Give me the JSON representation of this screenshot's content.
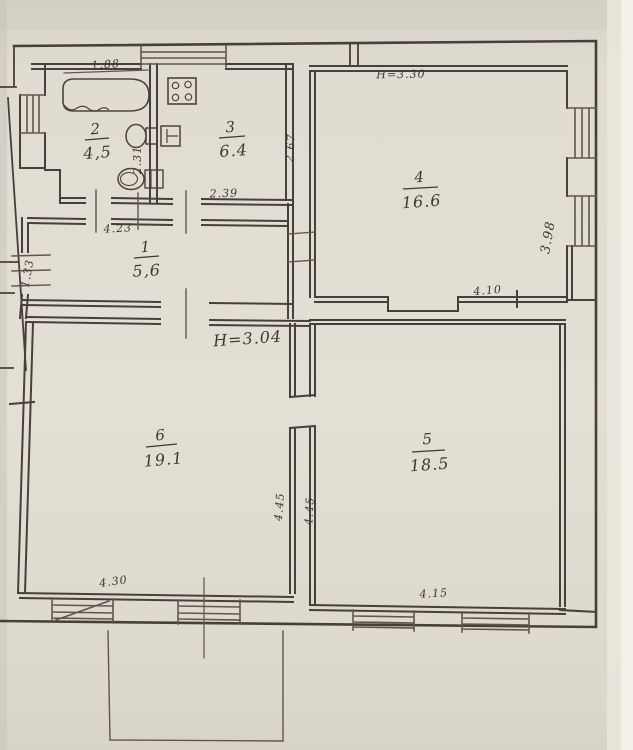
{
  "plan": {
    "rooms": {
      "hall": {
        "number": "1",
        "area": "5,6"
      },
      "bath": {
        "number": "2",
        "area": "4,5"
      },
      "kitchen": {
        "number": "3",
        "area": "6.4"
      },
      "room4": {
        "number": "4",
        "area": "16.6"
      },
      "room5": {
        "number": "5",
        "area": "18.5"
      },
      "room6": {
        "number": "6",
        "area": "19.1"
      }
    },
    "heights": {
      "upper": "H=3.30",
      "lower": "H=3.04"
    },
    "dims": {
      "bath_top": "1.88",
      "wc": "2.31",
      "kitchen_bottom": "2.39",
      "kitchen_right": "2.67",
      "hall_top": "4.23",
      "hall_left": "1.33",
      "room4_right": "3.98",
      "room4_bottom": "4.10",
      "room6_right": "4.45",
      "room5_left": "4.45",
      "room6_bottom": "4.30",
      "room5_bottom": "4.15"
    }
  }
}
